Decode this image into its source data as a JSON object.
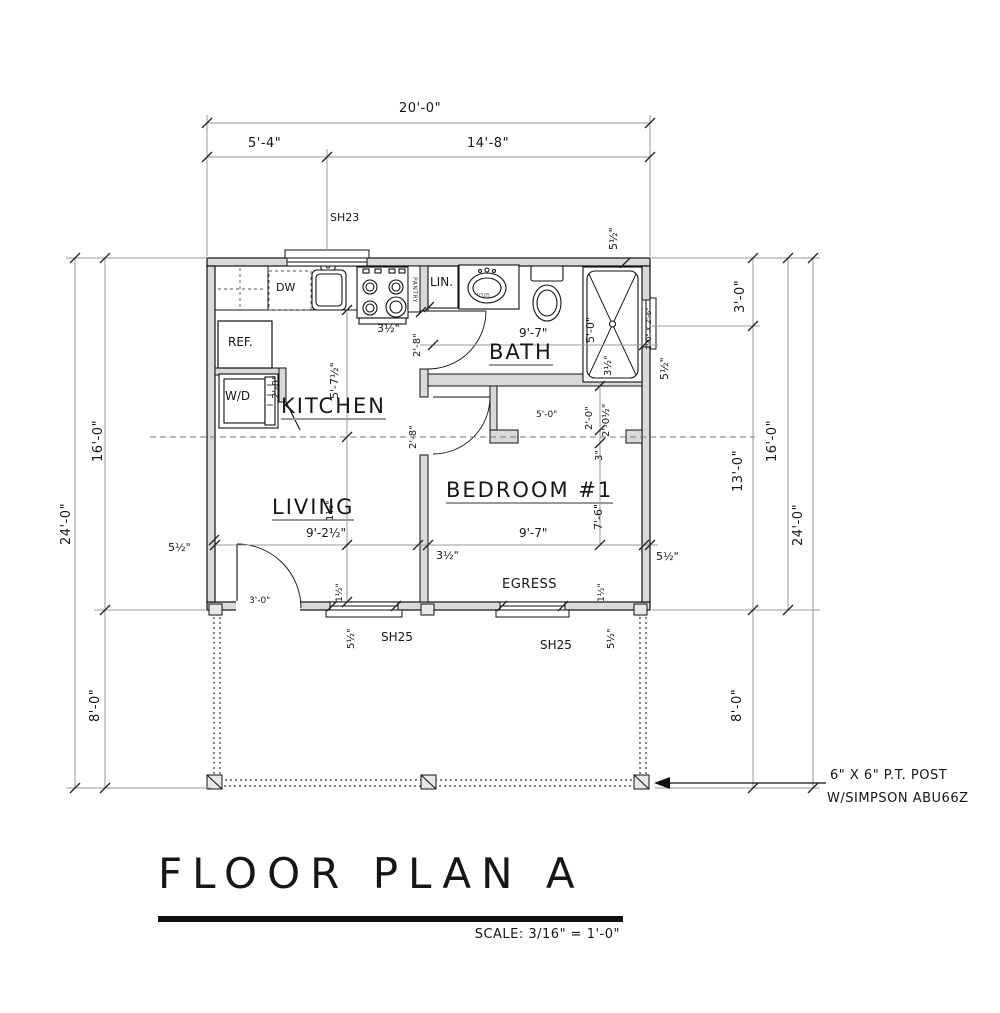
{
  "title": {
    "text": "FLOOR PLAN A",
    "scale": "SCALE: 3/16\" = 1'-0\""
  },
  "note": {
    "line1": "6\" X 6\" P.T. POST",
    "line2": "W/SIMPSON ABU66Z"
  },
  "rooms": {
    "kitchen": "KITCHEN",
    "living": "LIVING",
    "bath": "BATH",
    "bedroom": "BEDROOM #1"
  },
  "fixtures": {
    "dw": "DW",
    "ref": "REF.",
    "wd": "W/D",
    "lin": "LIN.",
    "pantry": "PANTRY",
    "vanity_model": "V305"
  },
  "windows": {
    "sh23": "SH23",
    "sh25_left": "SH25",
    "sh25_right": "SH25",
    "egress": "EGRESS"
  },
  "dims": {
    "top_total": "20'-0\"",
    "top_a": "5'-4\"",
    "top_b": "14'-8\"",
    "left_total": "24'-0\"",
    "left_main": "16'-0\"",
    "left_deck": "8'-0\"",
    "right_a": "3'-0\"",
    "right_b": "13'-0\"",
    "right_main": "16'-0\"",
    "right_total": "24'-0\"",
    "right_deck": "8'-0\"",
    "wall_top_right": "5½\"",
    "wall_left": "5½\"",
    "wall_right": "5½\"",
    "wall_right_window": "5½\"",
    "kitchen_depth": "5'-7½\"",
    "kitchen_wall": "3½\"",
    "bath_width": "9'-7\"",
    "shower_length": "5'-0\"",
    "shower_width": "3½\"",
    "shower_window_size": "2'-0\" X 2'-6\"",
    "closet_width": "5'-0\"",
    "closet_depth": "2'-0\"",
    "closet_depth2": "2'-0½\"",
    "closet_stub": "3\"",
    "bedroom_depth": "7'-6\"",
    "bedroom_width": "9'-7\"",
    "living_width": "9'-2½\"",
    "living_mid": "1½\"",
    "bottom_wall": "3½\"",
    "door_front": "3'-0\"",
    "door_bath": "2'-8\"",
    "door_bedroom": "2'-8\"",
    "door_wd": "2'-0\"",
    "win_left_jamb": "1½\"",
    "win_right_jamb": "1½\"",
    "win_left_wall": "5½\"",
    "win_right_wall": "5½\""
  }
}
